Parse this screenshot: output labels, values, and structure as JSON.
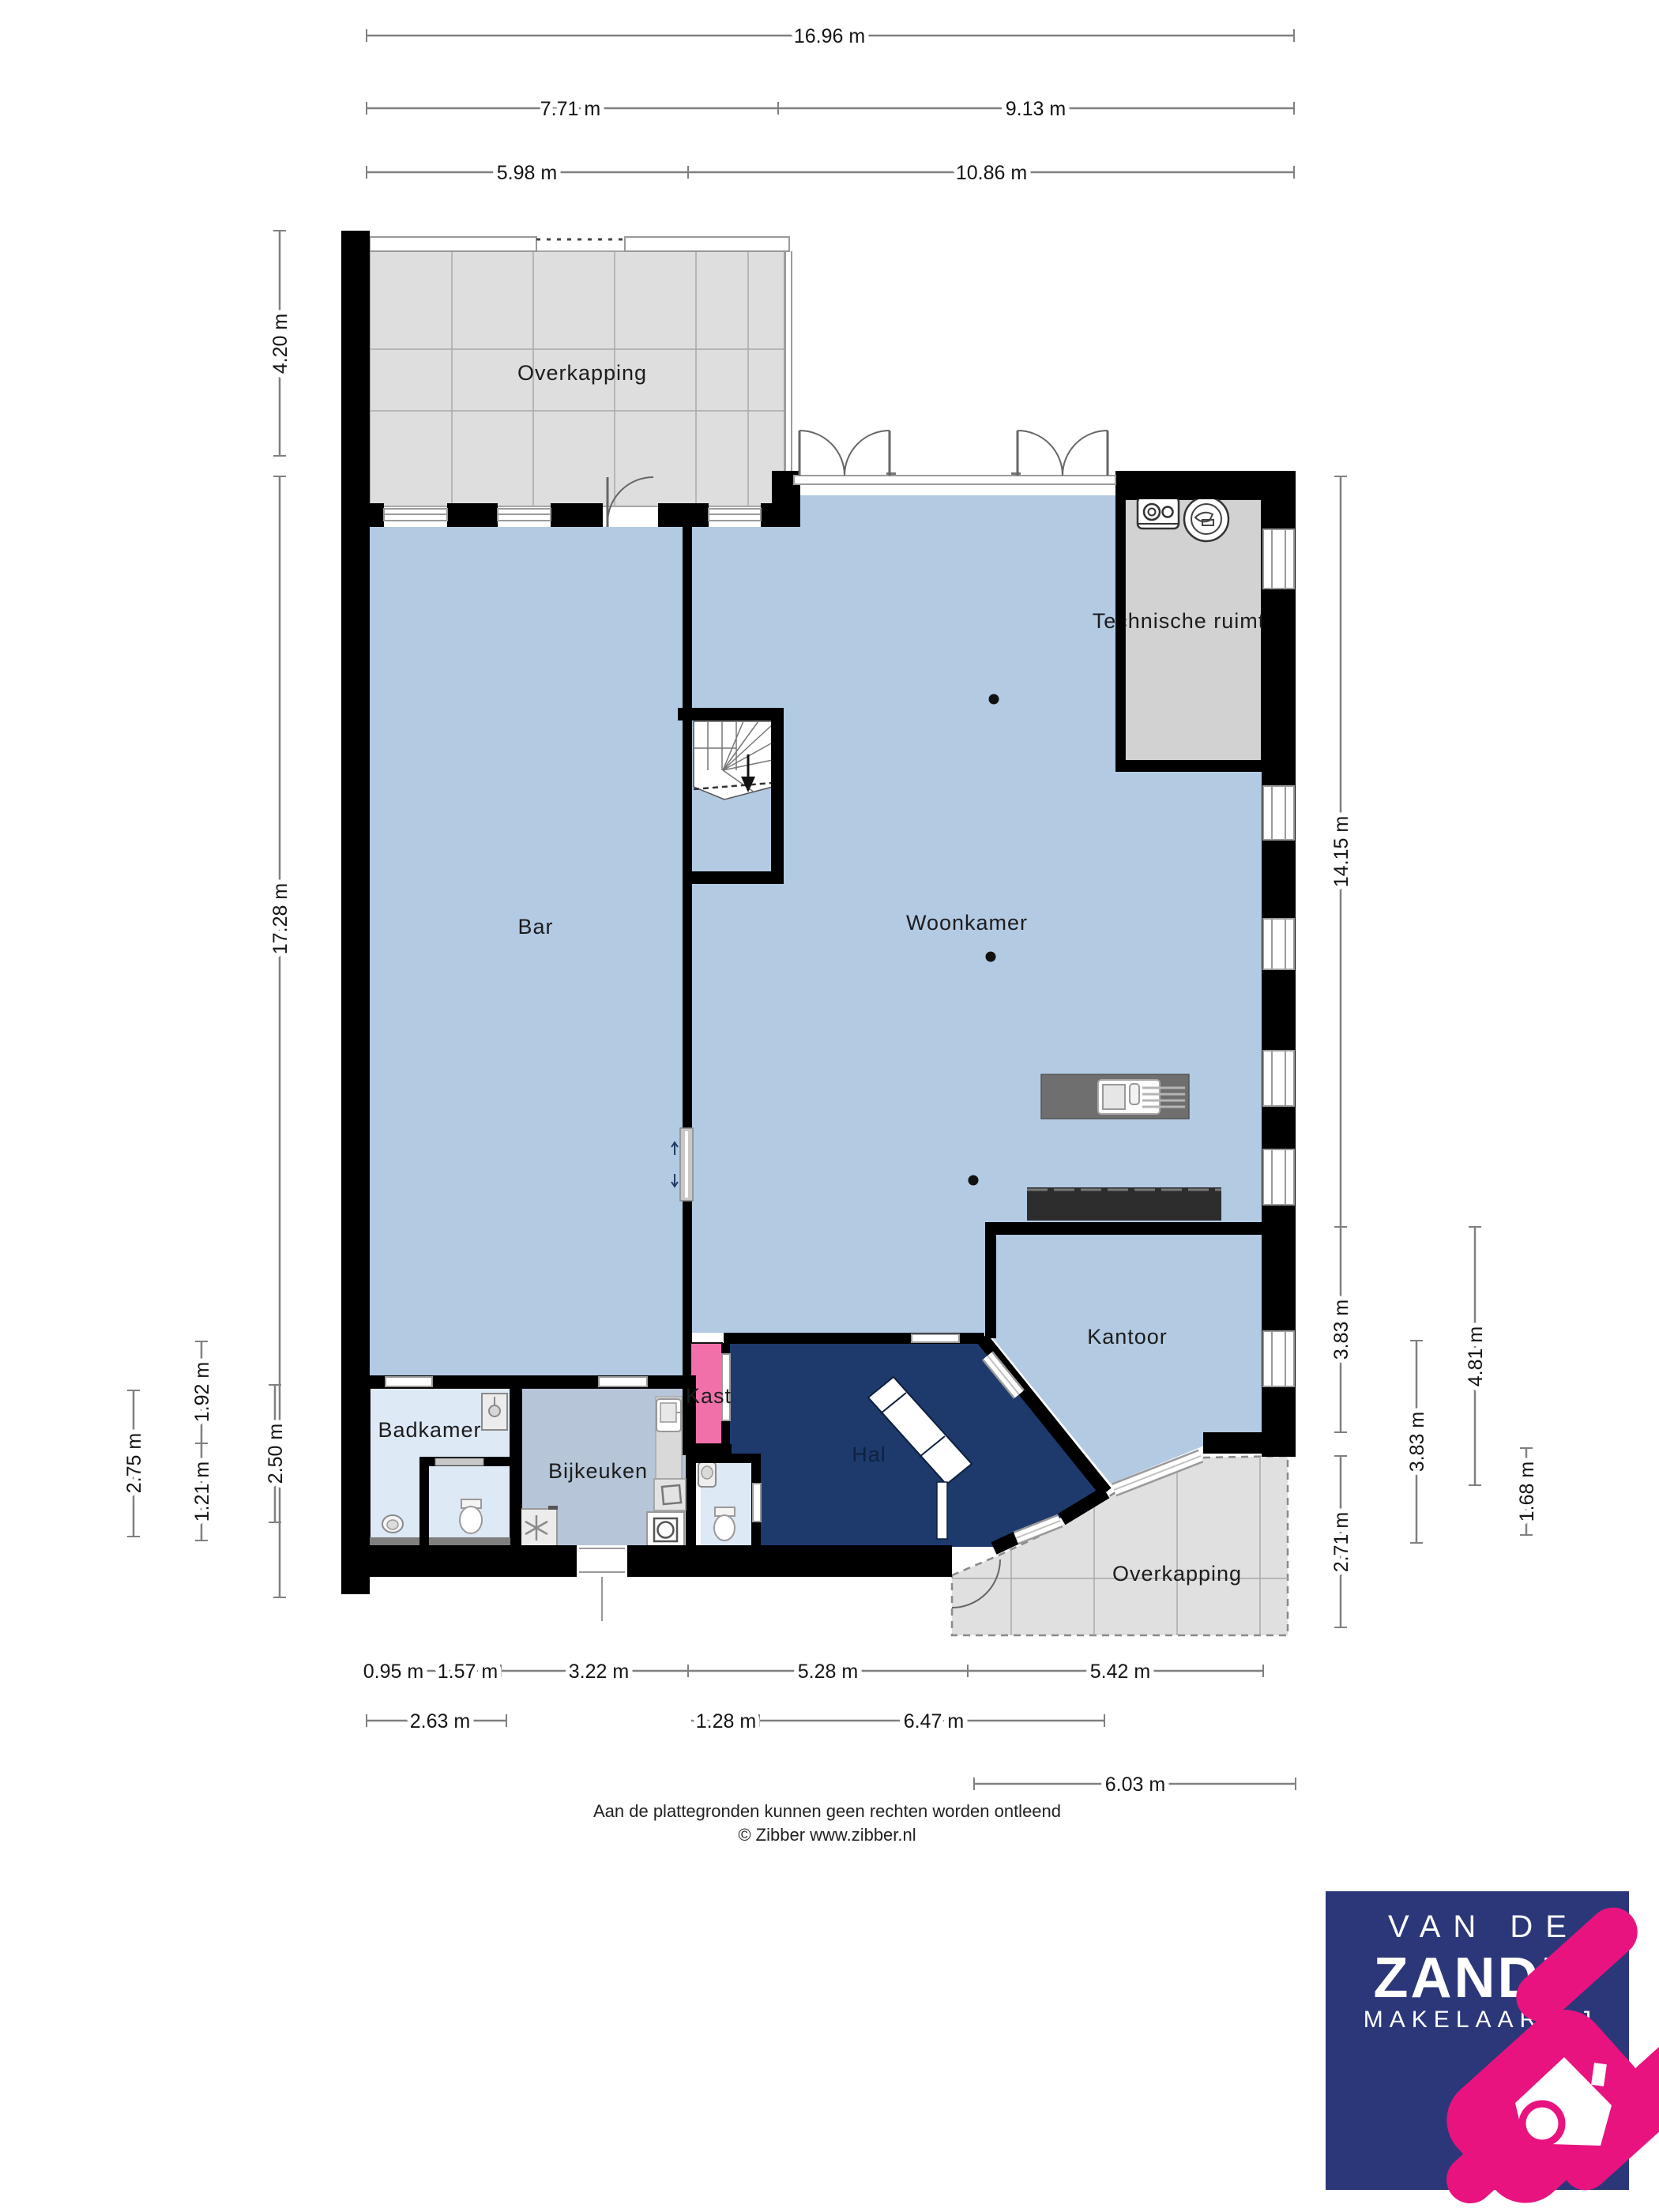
{
  "plan": {
    "rooms": {
      "overkapping_top": "Overkapping",
      "bar": "Bar",
      "woonkamer": "Woonkamer",
      "technische_ruimte": "Technische ruimte",
      "kast": "Kast",
      "hal": "Hal",
      "kantoor": "Kantoor",
      "bijkeuken": "Bijkeuken",
      "badkamer": "Badkamer",
      "overkapping_bottom": "Overkapping"
    },
    "dimensions": {
      "top": [
        "16.96 m",
        "7.71 m",
        "9.13 m",
        "5.98 m",
        "10.86 m"
      ],
      "left": [
        "4.20 m",
        "17.28 m",
        "2.75 m",
        "1.92 m",
        "1.21 m",
        "2.50 m"
      ],
      "right": [
        "14.15 m",
        "3.83 m",
        "2.71 m",
        "3.83 m",
        "4.81 m",
        "1.68 m"
      ],
      "bottom": [
        "0.95 m",
        "1.57 m",
        "3.22 m",
        "5.28 m",
        "5.42 m",
        "2.63 m",
        "1.28 m",
        "6.47 m",
        "6.03 m"
      ]
    },
    "icons": {
      "stairs": "winder-stairs-down-arrow",
      "boiler": "boiler-unit",
      "heat_pump": "round-ventilation-unit",
      "kitchen_island": "kitchen-island-sink-hob",
      "sideboard": "sideboard-block",
      "toilet": "toilet",
      "shower": "shower",
      "sink": "washbasin",
      "washer": "washing-machine",
      "fridge": "freezer-snowflake",
      "basket": "laundry-basket",
      "lamp": "ceiling-light-dot",
      "door": "door-swing-arc",
      "logo_mark": "house-with-magnifier"
    }
  },
  "footer": {
    "disclaimer": "Aan de plattegronden kunnen geen rechten worden ontleend",
    "copyright": "© Zibber www.zibber.nl"
  },
  "logo": {
    "line1": "VAN DE",
    "line2": "ZANDE",
    "line3": "MAKELAARDIJ"
  },
  "colors": {
    "wall": "#000000",
    "room_blue": "#b3cae3",
    "room_blue_muted": "#b6c5d8",
    "room_light": "#dde9f4",
    "hal_navy": "#1e3a6d",
    "kast_pink": "#f170a9",
    "overkapping_gray": "#dedede",
    "technical_gray": "#d2d2d2",
    "dim_line": "#808080",
    "logo_navy": "#2b3778",
    "logo_pink": "#e8137f"
  }
}
